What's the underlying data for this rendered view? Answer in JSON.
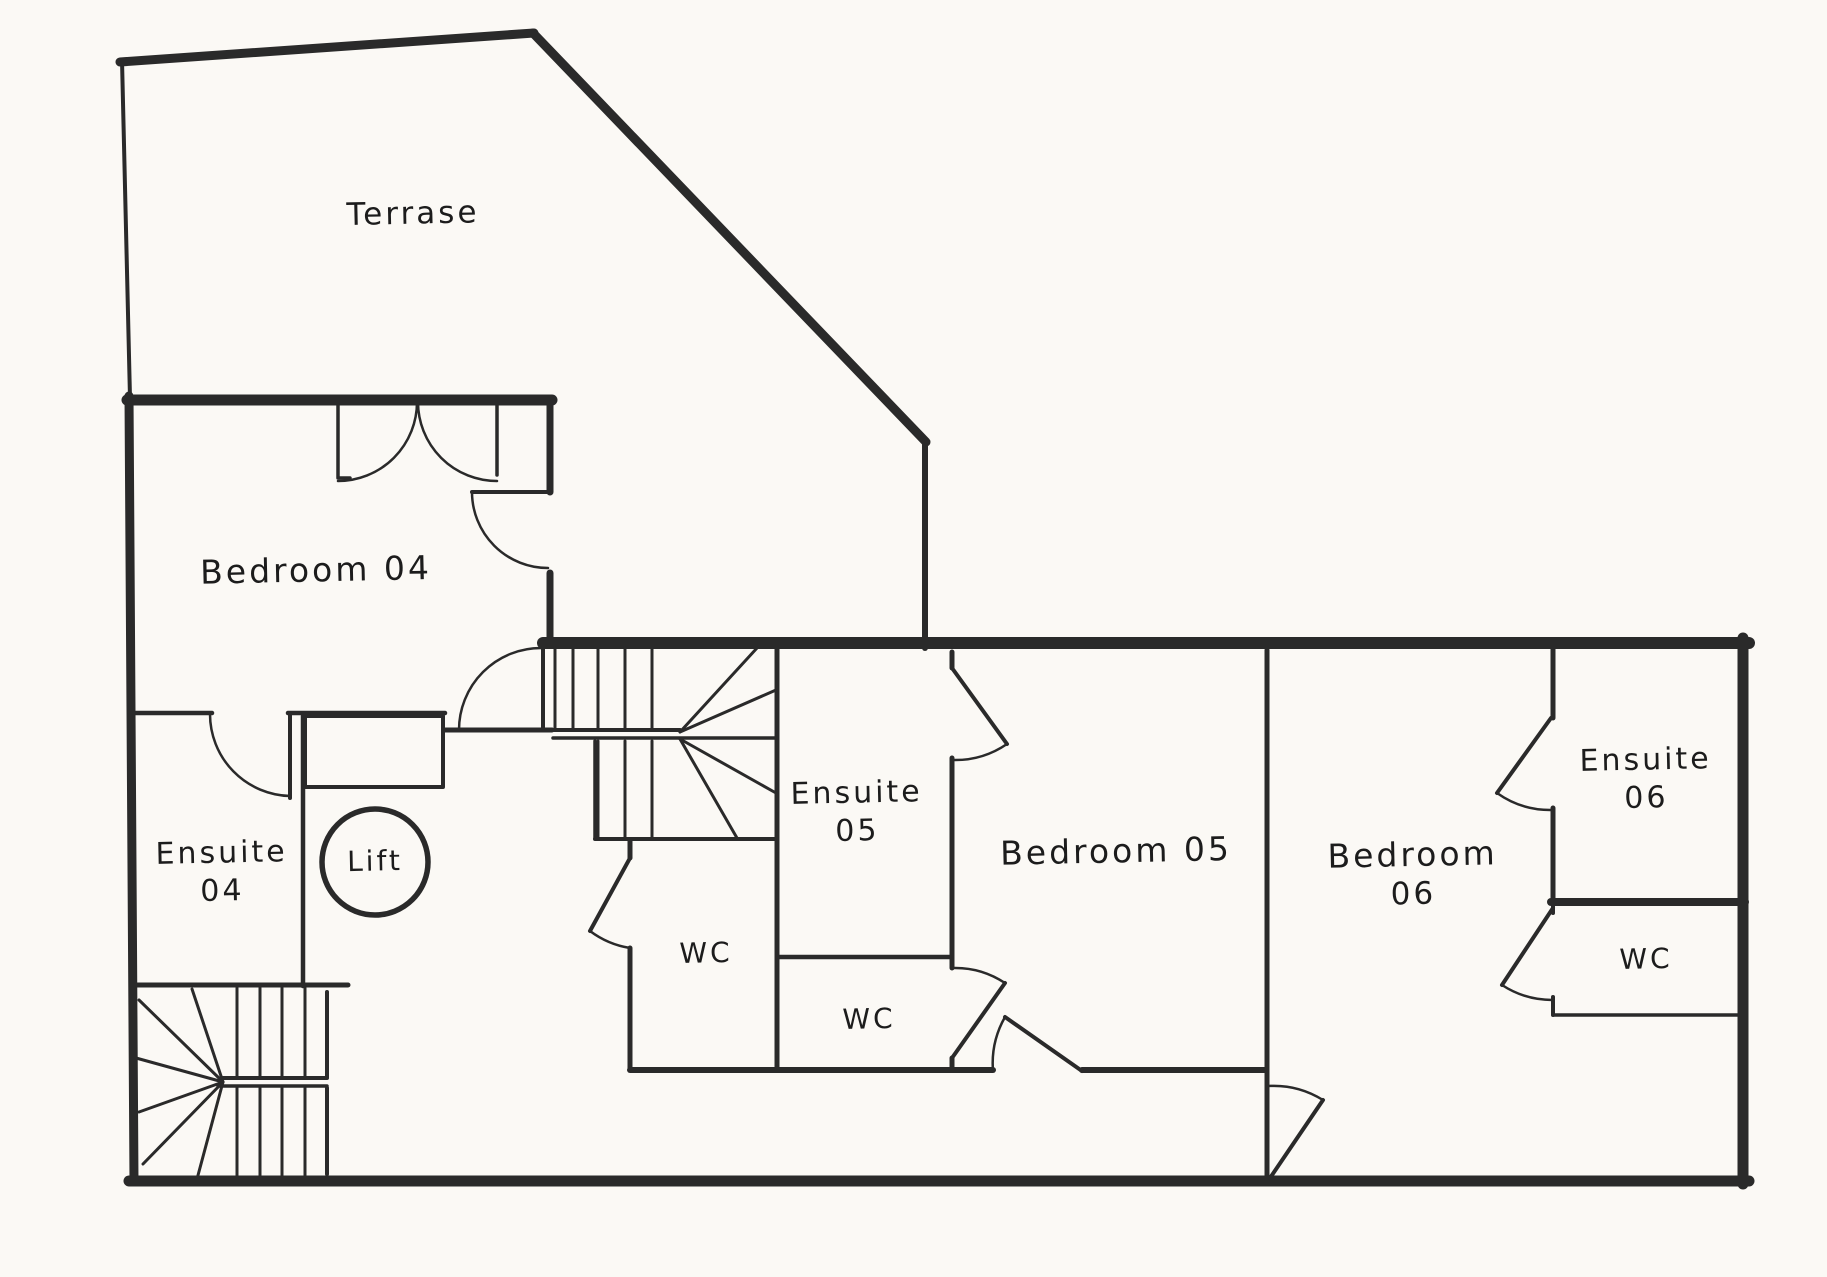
{
  "colors": {
    "background": "#fbf9f5",
    "line": "#2a2a2a",
    "text": "#1c1c1c"
  },
  "rooms": {
    "terrace": {
      "label": "Terrase"
    },
    "bedroom04": {
      "label": "Bedroom 04"
    },
    "ensuite04": {
      "line1": "Ensuite",
      "line2": "04"
    },
    "lift": {
      "label": "Lift"
    },
    "hall_wc": {
      "label": "WC"
    },
    "ensuite05": {
      "line1": "Ensuite",
      "line2": "05"
    },
    "wc05": {
      "label": "WC"
    },
    "bedroom05": {
      "label": "Bedroom 05"
    },
    "bedroom06": {
      "line1": "Bedroom",
      "line2": "06"
    },
    "ensuite06": {
      "line1": "Ensuite",
      "line2": "06"
    },
    "wc06": {
      "label": "WC"
    }
  }
}
